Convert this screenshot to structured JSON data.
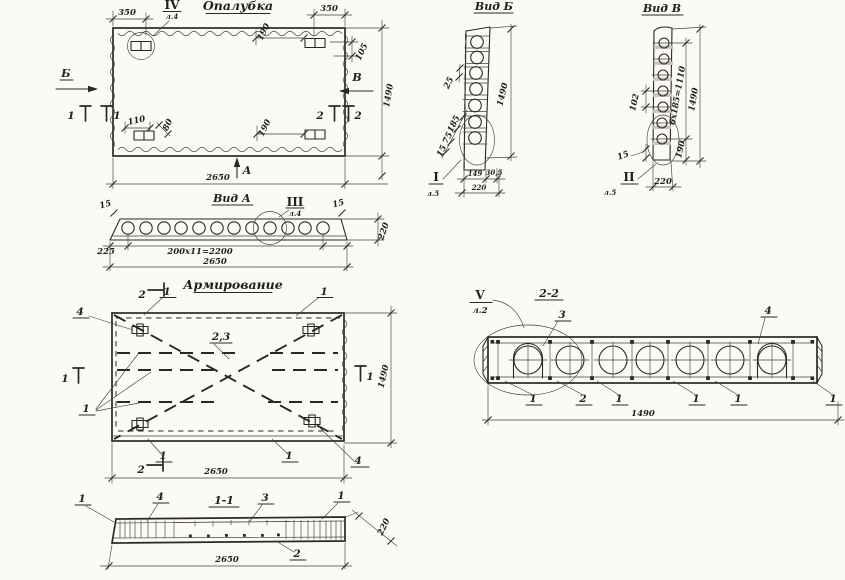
{
  "colors": {
    "paper": "#fbfaf6",
    "ink": "#2b2823"
  },
  "formwork": {
    "title": "Опалубка",
    "dim_350": "350",
    "dim_190": "190",
    "dim_105": "105",
    "dim_1490": "1490",
    "dim_2650": "2650",
    "dim_110": "110",
    "dim_80": "80",
    "view_a": "А",
    "view_b": "Б",
    "view_v": "В",
    "cut_1": "1",
    "cut_2": "2",
    "detail": "IV",
    "detail_sheet": "л.4"
  },
  "vid_a": {
    "title": "Вид А",
    "detail": "III",
    "detail_sheet": "л.4",
    "dim_15": "15",
    "dim_220": "220",
    "dim_225": "225",
    "dim_spacing": "200х11=2200",
    "dim_2650": "2650"
  },
  "vid_b": {
    "title": "Вид Б",
    "detail": "I",
    "detail_sheet": "л.5",
    "dim_25": "25",
    "dim_185": "185",
    "dim_75": "75",
    "dim_15": "15",
    "dim_1490": "1490",
    "dim_149": "149",
    "dim_30_5": "30,5",
    "dim_220": "220"
  },
  "vid_v": {
    "title": "Вид В",
    "detail": "II",
    "detail_sheet": "л.5",
    "dim_102": "102",
    "dim_15": "15",
    "dim_190": "190",
    "dim_spacing": "6х185=1110",
    "dim_1490": "1490",
    "dim_220": "220"
  },
  "reinforcement": {
    "title": "Армирование",
    "pos_1": "1",
    "pos_4": "4",
    "pos_23": "2,3",
    "cut_1": "1",
    "cut_2": "2",
    "dim_1490": "1490",
    "dim_2650": "2650"
  },
  "section_2_2": {
    "title": "2-2",
    "detail": "V",
    "detail_sheet": "л.2",
    "pos_1": "1",
    "pos_2": "2",
    "pos_3": "3",
    "pos_4": "4",
    "dim_1490": "1490"
  },
  "section_1_1": {
    "title": "1-1",
    "pos_1": "1",
    "pos_2": "2",
    "pos_3": "3",
    "pos_4": "4",
    "dim_2650": "2650",
    "dim_220": "220"
  }
}
